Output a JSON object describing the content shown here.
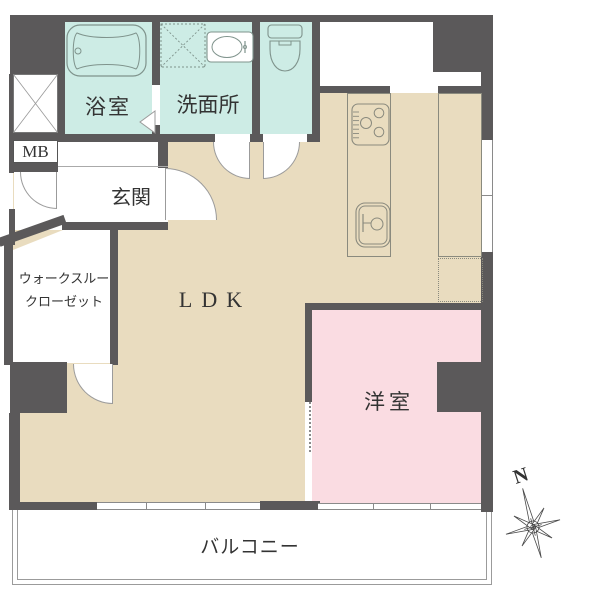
{
  "plan": {
    "title": "apartment-floor-plan",
    "rooms": {
      "bath": {
        "label": "浴室"
      },
      "washroom": {
        "label": "洗面所"
      },
      "toilet": {
        "label": ""
      },
      "meter_box": {
        "label": "MB"
      },
      "entrance": {
        "label": "玄関"
      },
      "walk_through_closet": {
        "label_line1": "ウォークスルー",
        "label_line2": "クローゼット"
      },
      "ldk": {
        "label": "LDK"
      },
      "western_room": {
        "label": "洋室"
      },
      "balcony": {
        "label": "バルコニー"
      }
    },
    "compass": {
      "north_label": "N"
    },
    "fixtures": [
      "bathtub",
      "washing-machine-space",
      "vanity-sink",
      "toilet",
      "gas-stove",
      "kitchen-sink",
      "kitchen-counter",
      "refrigerator-space",
      "pipe-shaft"
    ],
    "colors": {
      "wall": "#5b595a",
      "wet_room_floor": "#cdece5",
      "ldk_floor": "#e9dcbf",
      "western_room_floor": "#fadce2",
      "thin_line": "#9b9b9b",
      "fixture_line": "#8a8a7e",
      "text": "#333333"
    }
  }
}
